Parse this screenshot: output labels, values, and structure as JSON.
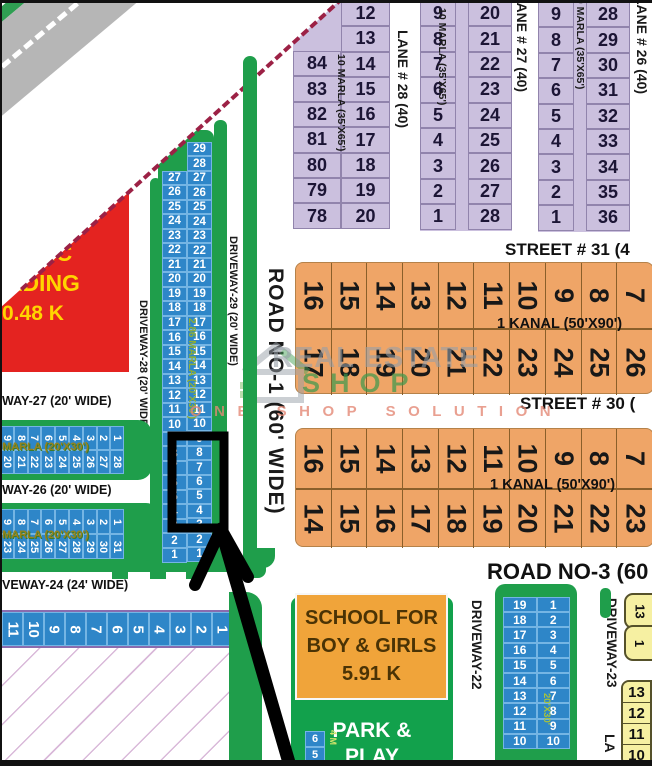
{
  "map_title": "housing scheme plot map",
  "colors": {
    "plot_blue": "#2e86c8",
    "plot_purple": "#cbc0de",
    "plot_orange": "#efa567",
    "plot_yellow": "#f6f0a2",
    "verge_green": "#1f9e4b",
    "building_red": "#e42320",
    "building_text_yellow": "#ffd400",
    "boundary_dash": "#9c2145",
    "watermark_green": "#3e984e",
    "watermark_salmon": "#e38876"
  },
  "watermark": {
    "brand_top": "REAL ESTATE",
    "brand_bottom": "SHOP",
    "tagline": "ONE SHOP SOLUTION"
  },
  "building": {
    "lines": [
      "UBLIC",
      "ILDING",
      "0.48 K"
    ]
  },
  "school": {
    "lines": [
      "SCHOOL FOR",
      "BOY & GIRLS",
      "5.91 K"
    ]
  },
  "park": {
    "lines": [
      "PARK &",
      "PLAY"
    ],
    "mini_label": "4 M"
  },
  "labels": {
    "lane28": "LANE # 28 (40)",
    "lane27": "LANE # 27 (40)",
    "lane26": "LANE # 26 (40)",
    "marla10": "10 MARLA (35'X65')",
    "street31": "STREET # 31 (4",
    "street30": "STREET # 30 (",
    "kanal": "1 KANAL (50'X90')",
    "road1": "ROAD NO-1 (60' WIDE)",
    "road3": "ROAD NO-3 (60",
    "driveway29": "DRIVEWAY-29 (20' WIDE)",
    "driveway28": "DRIVEWAY-28 (20' WIDE)",
    "way27": "WAY-27 (20' WIDE)",
    "way26": "WAY-26 (20' WIDE)",
    "driveway24": "VEWAY-24 (24' WIDE)",
    "marla286": "2.86 MARLA (20'X30')",
    "marla2030": "MARLA (20'X30')",
    "driveway22": "DRIVEWAY-22",
    "driveway23": "DRIVEWAY-23",
    "cstrip_dim": "20'X30'",
    "lane_bottom": "LA"
  },
  "plots": {
    "purple1_left": [
      84,
      83,
      82,
      81,
      80,
      79,
      78
    ],
    "purple1_right": [
      12,
      13,
      14,
      15,
      16,
      17,
      18,
      19,
      20
    ],
    "purple2_left": [
      9,
      8,
      7,
      6,
      5,
      4,
      3,
      2,
      1
    ],
    "purple2_right": [
      20,
      21,
      22,
      23,
      24,
      25,
      26,
      27,
      28
    ],
    "purple3_left": [
      9,
      8,
      7,
      6,
      5,
      4,
      3,
      2,
      1
    ],
    "purple3_right": [
      28,
      29,
      30,
      31,
      32,
      33,
      34,
      35,
      36
    ],
    "kanalA_top": [
      16,
      15,
      14,
      13,
      12,
      11,
      10,
      9,
      8,
      7
    ],
    "kanalA_bottom": [
      17,
      18,
      19,
      20,
      21,
      22,
      23,
      24,
      25,
      26
    ],
    "kanalB_top": [
      16,
      15,
      14,
      13,
      12,
      11,
      10,
      9,
      8,
      7
    ],
    "kanalB_bottom": [
      14,
      15,
      16,
      17,
      18,
      19,
      20,
      21,
      22,
      23
    ],
    "vstrip_left": [
      27,
      26,
      25,
      24,
      23,
      22,
      21,
      20,
      19,
      18,
      17,
      16,
      15,
      14,
      13,
      12,
      11,
      10,
      9,
      8,
      7,
      6,
      5,
      4,
      3,
      2,
      1
    ],
    "vstrip_right": [
      29,
      28,
      27,
      26,
      25,
      24,
      23,
      22,
      21,
      20,
      19,
      18,
      17,
      16,
      15,
      14,
      13,
      12,
      11,
      10,
      9,
      8,
      7,
      6,
      5,
      4,
      3,
      2,
      1
    ],
    "stripA_top": [
      9,
      8,
      7,
      6,
      5,
      4,
      3,
      2,
      1
    ],
    "stripA_bottom": [
      20,
      21,
      22,
      23,
      24,
      25,
      26,
      27,
      28
    ],
    "stripB_top": [
      9,
      8,
      7,
      6,
      5,
      4,
      3,
      2,
      1
    ],
    "stripB_bottom": [
      23,
      24,
      25,
      26,
      27,
      28,
      29,
      30,
      31
    ],
    "bottom_row": [
      11,
      10,
      9,
      8,
      7,
      6,
      5,
      4,
      3,
      2,
      1
    ],
    "cstrip_left": [
      19,
      18,
      17,
      16,
      15,
      14,
      13,
      12,
      11,
      10
    ],
    "cstrip_right": [
      1,
      2,
      3,
      4,
      5,
      6,
      7,
      8,
      9,
      10
    ],
    "park_mini": [
      6,
      5
    ],
    "yellow_top": [
      13,
      1
    ],
    "yellow_group": [
      13,
      12,
      11,
      10
    ]
  }
}
